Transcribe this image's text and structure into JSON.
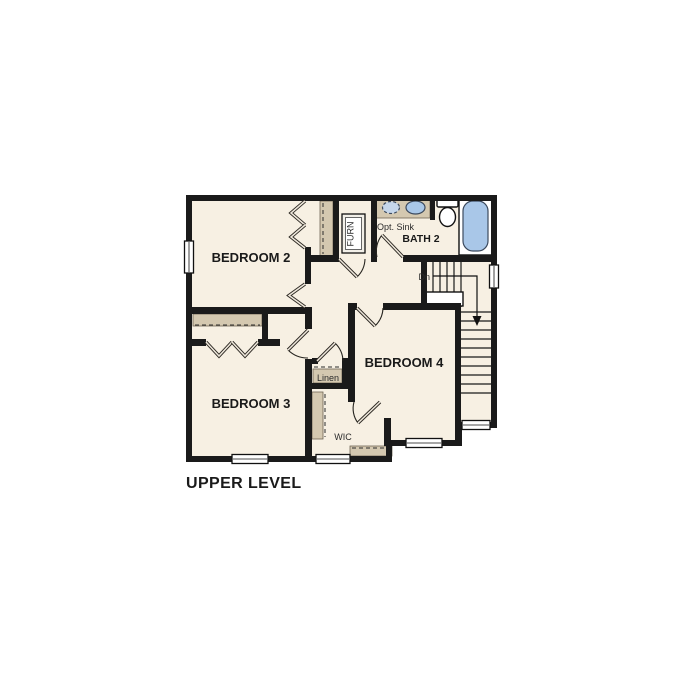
{
  "title": "UPPER LEVEL",
  "rooms": {
    "bedroom2": "BEDROOM 2",
    "bedroom3": "BEDROOM 3",
    "bedroom4": "BEDROOM 4",
    "bath2": "BATH 2",
    "wic": "WIC",
    "linen": "Linen",
    "furn": "FURN"
  },
  "annotations": {
    "opt_sink": "Opt. Sink",
    "stairs_down": "Dn"
  },
  "colors": {
    "background": "#ffffff",
    "floor": "#f7f0e3",
    "wall": "#1a1a1a",
    "shelf": "#d4c8b0",
    "fixture_blue": "#a9c7e8",
    "text": "#1a1a1a"
  }
}
